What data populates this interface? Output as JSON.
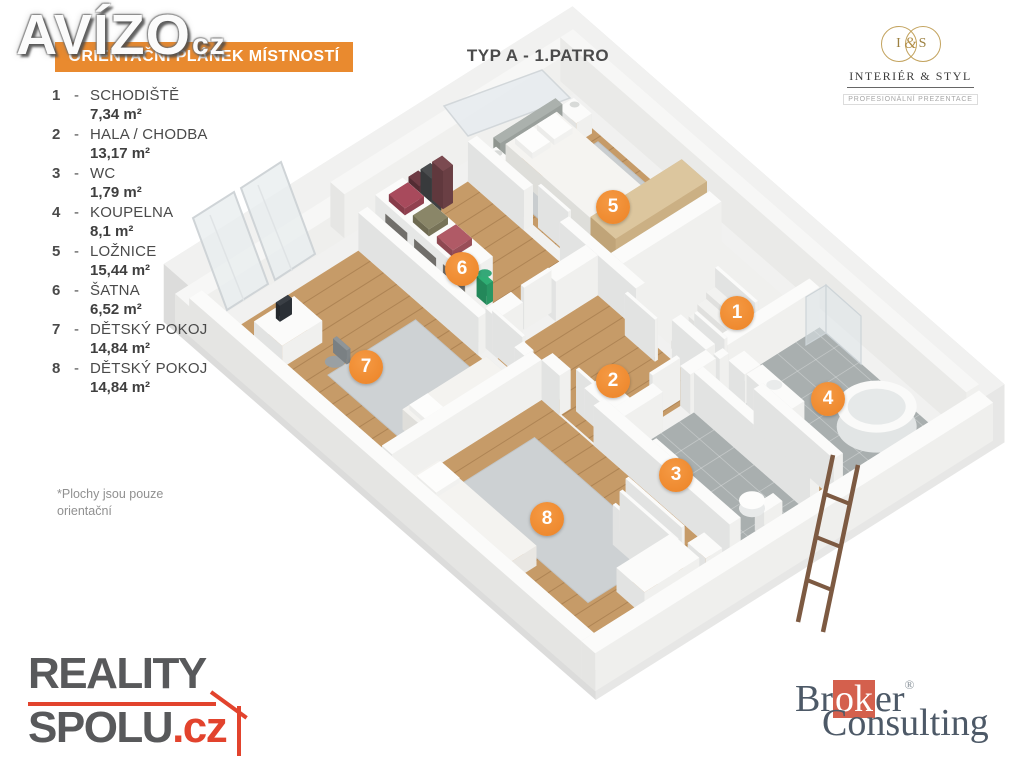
{
  "watermark": {
    "text": "AVÍZO",
    "suffix": "cz"
  },
  "header": {
    "banner": "ORIENTAČNÍ PLÁNEK MÍSTNOSTÍ",
    "title": "TYP A - 1.PATRO"
  },
  "partner_logo": {
    "left_initial": "I",
    "ampersand": "&",
    "right_initial": "S",
    "name": "INTERIÉR & STYL",
    "tagline": "PROFESIONÁLNÍ PREZENTACE"
  },
  "legend": {
    "items": [
      {
        "num": "1",
        "name": "SCHODIŠTĚ",
        "area": "7,34 m²"
      },
      {
        "num": "2",
        "name": "HALA / CHODBA",
        "area": "13,17 m²"
      },
      {
        "num": "3",
        "name": "WC",
        "area": "1,79 m²"
      },
      {
        "num": "4",
        "name": "KOUPELNA",
        "area": "8,1 m²"
      },
      {
        "num": "5",
        "name": "LOŽNICE",
        "area": "15,44 m²"
      },
      {
        "num": "6",
        "name": "ŠATNA",
        "area": "6,52 m²"
      },
      {
        "num": "7",
        "name": "DĚTSKÝ POKOJ",
        "area": "14,84 m²"
      },
      {
        "num": "8",
        "name": "DĚTSKÝ POKOJ",
        "area": "14,84 m²"
      }
    ],
    "note": [
      "*Plochy jsou pouze",
      "orientační"
    ]
  },
  "plan": {
    "markers": [
      {
        "num": "1",
        "x": 737,
        "y": 313
      },
      {
        "num": "2",
        "x": 613,
        "y": 381
      },
      {
        "num": "3",
        "x": 676,
        "y": 475
      },
      {
        "num": "4",
        "x": 828,
        "y": 399
      },
      {
        "num": "5",
        "x": 613,
        "y": 207
      },
      {
        "num": "6",
        "x": 462,
        "y": 269
      },
      {
        "num": "7",
        "x": 366,
        "y": 367
      },
      {
        "num": "8",
        "x": 547,
        "y": 519
      }
    ]
  },
  "footer": {
    "agency": {
      "line1": "REALITY",
      "line2": "SPOLU",
      "tld": ".cz"
    },
    "broker": {
      "pre": "Br",
      "boxed": "ok",
      "post": "er",
      "reg": "®",
      "line2": "Consulting"
    }
  },
  "colors": {
    "accent_orange": "#ee8a30",
    "wood_floor": "#c69b68",
    "tile_floor": "#a9afaf",
    "rug_gray": "#cdd1d3",
    "agency_red": "#e2432d",
    "broker_red": "#d4604d",
    "broker_gray": "#4d5967",
    "logo_gold": "#c3a35e"
  }
}
